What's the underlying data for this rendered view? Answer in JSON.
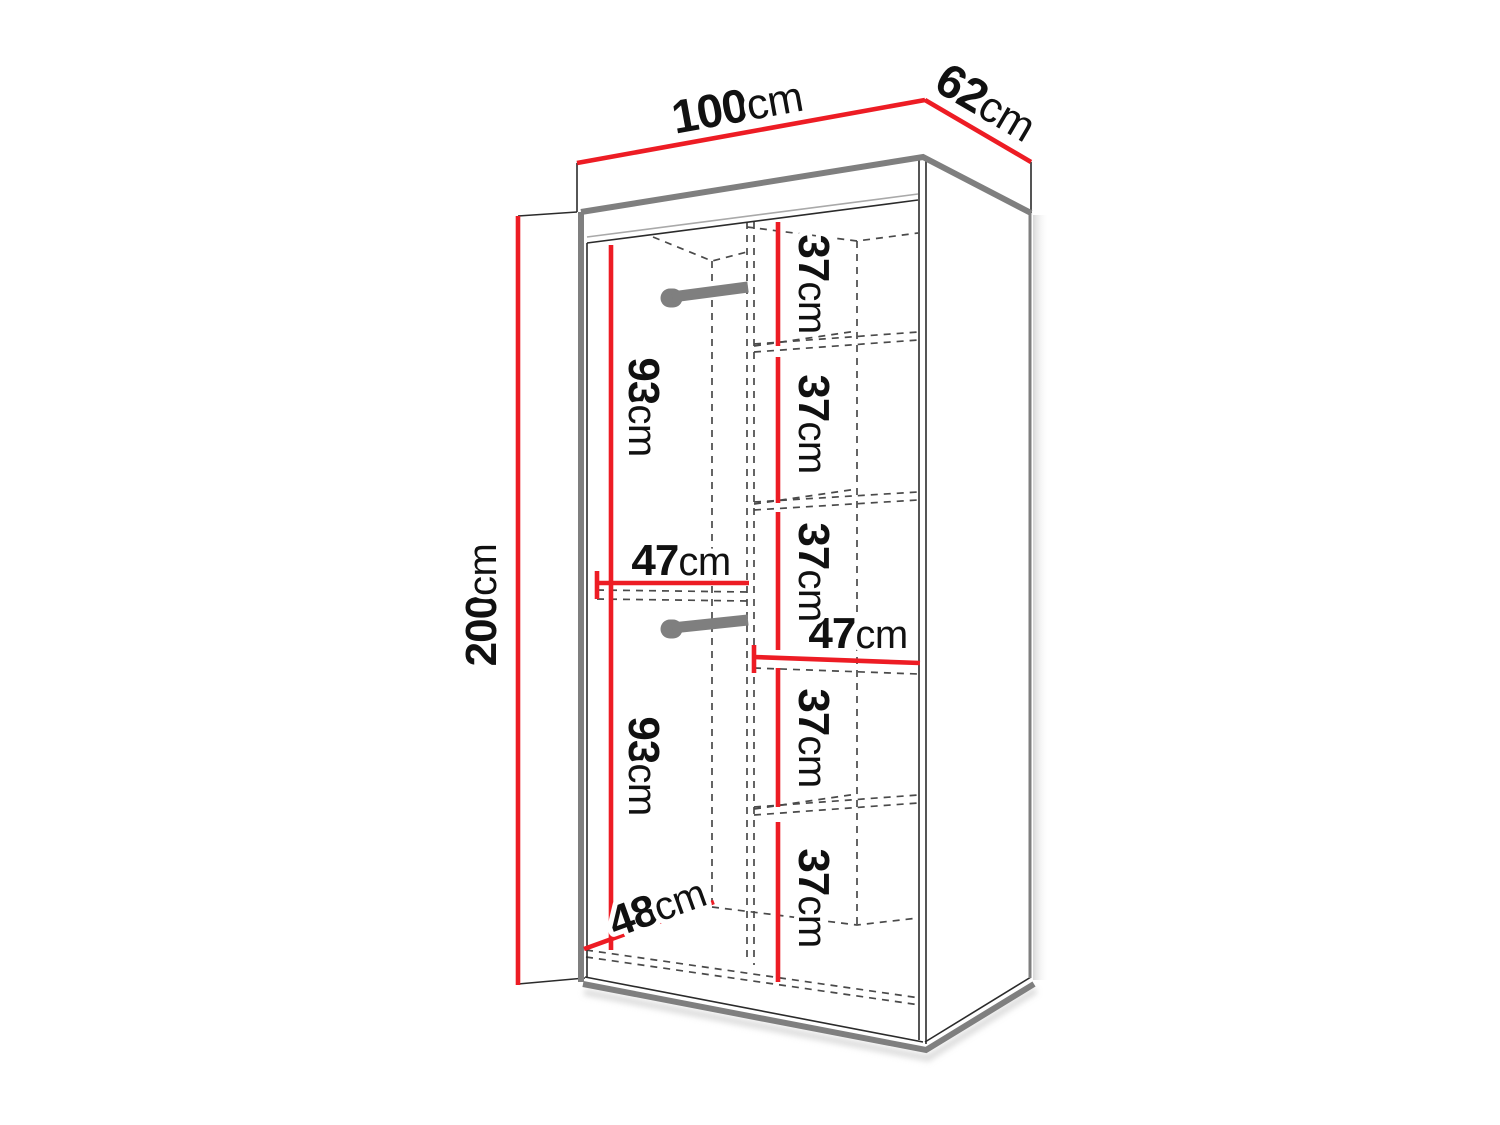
{
  "meta": {
    "description": "Wardrobe dimension diagram, perspective line drawing with red dimension lines"
  },
  "colors": {
    "accent": "#ed1c24",
    "outline": "#2b2b2b",
    "panel": "#7f7f7f",
    "dash": "#4a4a4a",
    "text": "#111111",
    "shadow": "#c9c9c9"
  },
  "dimensions": {
    "total_width": {
      "num": "100",
      "unit": "cm"
    },
    "total_depth": {
      "num": "62",
      "unit": "cm"
    },
    "total_height": {
      "num": "200",
      "unit": "cm"
    },
    "upper_hanging_height": {
      "num": "93",
      "unit": "cm"
    },
    "lower_hanging_height": {
      "num": "93",
      "unit": "cm"
    },
    "left_section_width": {
      "num": "47",
      "unit": "cm"
    },
    "right_shelf_width": {
      "num": "47",
      "unit": "cm"
    },
    "interior_depth": {
      "num": "48",
      "unit": "cm"
    },
    "shelf_spacings": [
      {
        "num": "37",
        "unit": "cm"
      },
      {
        "num": "37",
        "unit": "cm"
      },
      {
        "num": "37",
        "unit": "cm"
      },
      {
        "num": "37",
        "unit": "cm"
      },
      {
        "num": "37",
        "unit": "cm"
      }
    ]
  }
}
